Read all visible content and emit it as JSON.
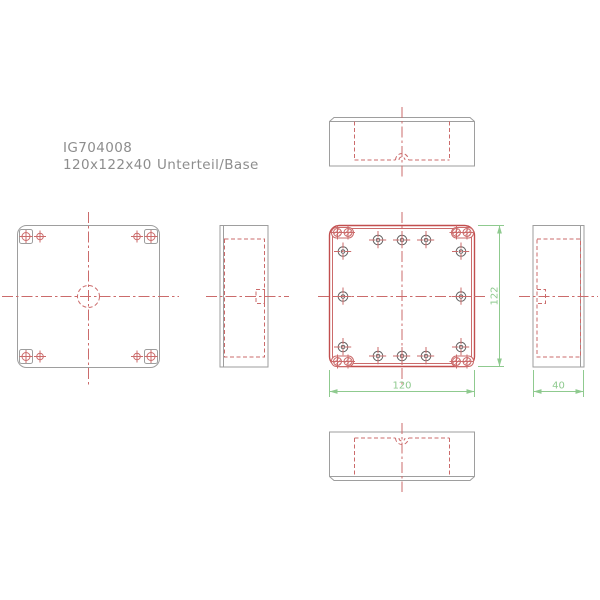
{
  "title": {
    "article": "IG704008",
    "size": "120x122x40",
    "name": "Unterteil/Base"
  },
  "dimensions": {
    "width": "120",
    "height": "122",
    "depth": "40"
  },
  "colors": {
    "background": "#ffffff",
    "line_gray": "#9e9e9e",
    "line_red": "#cb6b6b",
    "line_red_strong": "#c24e4e",
    "hatch_red": "#d98c8c",
    "boss_gray": "#666666",
    "dim_green": "#8fca8f",
    "text_gray": "#8d8d8d"
  }
}
